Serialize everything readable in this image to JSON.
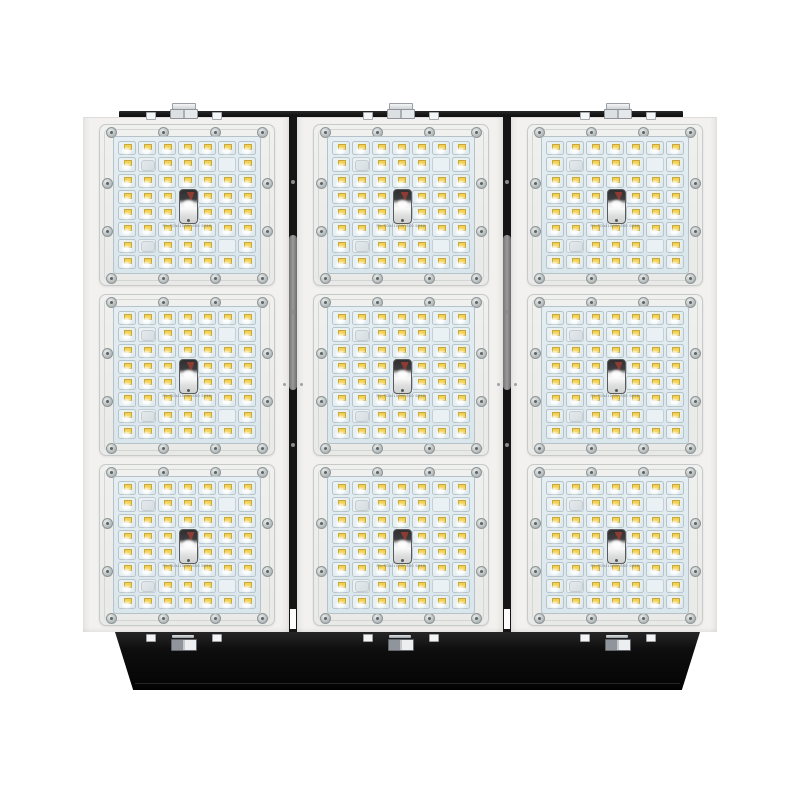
{
  "product": {
    "description": "Modular LED floodlight, front view: 3 columns x 3 rows of LED modules on white panels, black top mounting rail with three bolt fixtures, black tapered driver housing at the bottom"
  },
  "fixture": {
    "columns": {
      "count": 3,
      "modules_per_column": 3
    },
    "led_grid": {
      "cols": 7,
      "rows": 8
    },
    "blank_cells": [
      {
        "row": 2,
        "col": 2,
        "style": "frosted"
      },
      {
        "row": 2,
        "col": 6,
        "style": "plain"
      },
      {
        "row": 7,
        "col": 2,
        "style": "frosted"
      },
      {
        "row": 7,
        "col": 6,
        "style": "plain"
      }
    ],
    "center_element": {
      "col": 4,
      "rows": [
        4,
        5
      ]
    },
    "module_marking": "PL-TDs/100W 840 5016",
    "hardware": {
      "rail_bolts": 3,
      "rail_nuts_per_bolt": 2,
      "driver_clips": 3,
      "screws_per_module": 12
    }
  },
  "colors": {
    "background": "#ffffff",
    "panel_white": "#f2f1ef",
    "module_frame": "#ededeb",
    "lens_plate": "#dfe9ee",
    "led_chip_yellow": "#f1d254",
    "rail_black": "#161616",
    "driver_black": "#0c0c0c",
    "bolt_silver": "#d6dadd",
    "gap_connector_gray": "#8f8f8f",
    "reflector_red": "#8d3b33"
  }
}
